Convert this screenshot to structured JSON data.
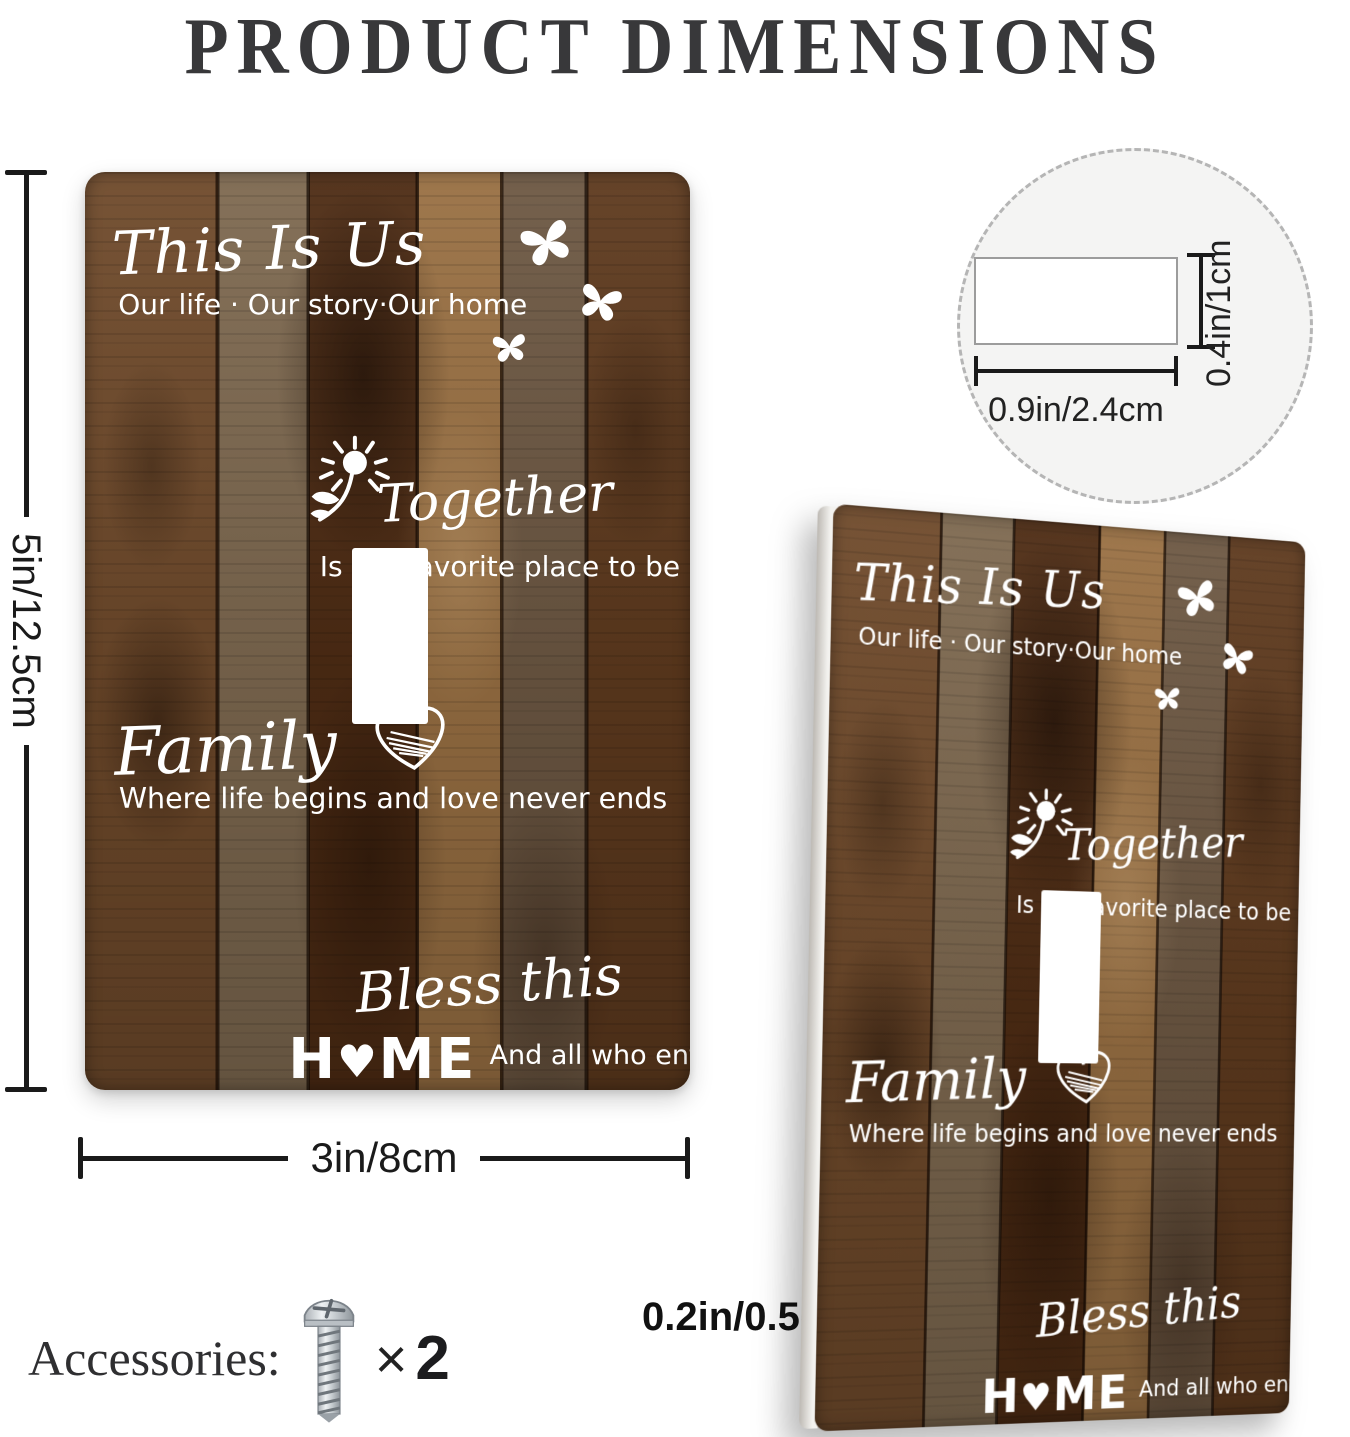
{
  "title": "PRODUCT DIMENSIONS",
  "plate": {
    "heading": "This Is Us",
    "subheading": "Our life · Our story·Our home",
    "together": "Together",
    "together_sub": "Is our favorite place to be",
    "family": "Family",
    "family_sub": "Where life begins and love never ends",
    "bless": "Bless this",
    "home_h": "H",
    "home_heart": "♥",
    "home_me": "ME",
    "home_sub": "And all who enter"
  },
  "dimensions": {
    "height_label": "5in/12.5cm",
    "width_label": "3in/8cm",
    "hole_width_label": "0.9in/2.4cm",
    "hole_height_label": "0.4in/1cm",
    "thickness_label": "0.2in/0.5cm"
  },
  "accessories": {
    "label": "Accessories:",
    "times_symbol": "×",
    "count": "2"
  },
  "colors": {
    "title_text": "#38383a",
    "dimension_line": "#1a1a1a",
    "plate_text": "#ffffff",
    "circle_fill": "#f4f4f3",
    "circle_border": "#b5b5b5",
    "wood_palette": [
      "#6f4a2b",
      "#7e6950",
      "#4e2c14",
      "#997043",
      "#6d5843",
      "#5e3a1e"
    ]
  }
}
